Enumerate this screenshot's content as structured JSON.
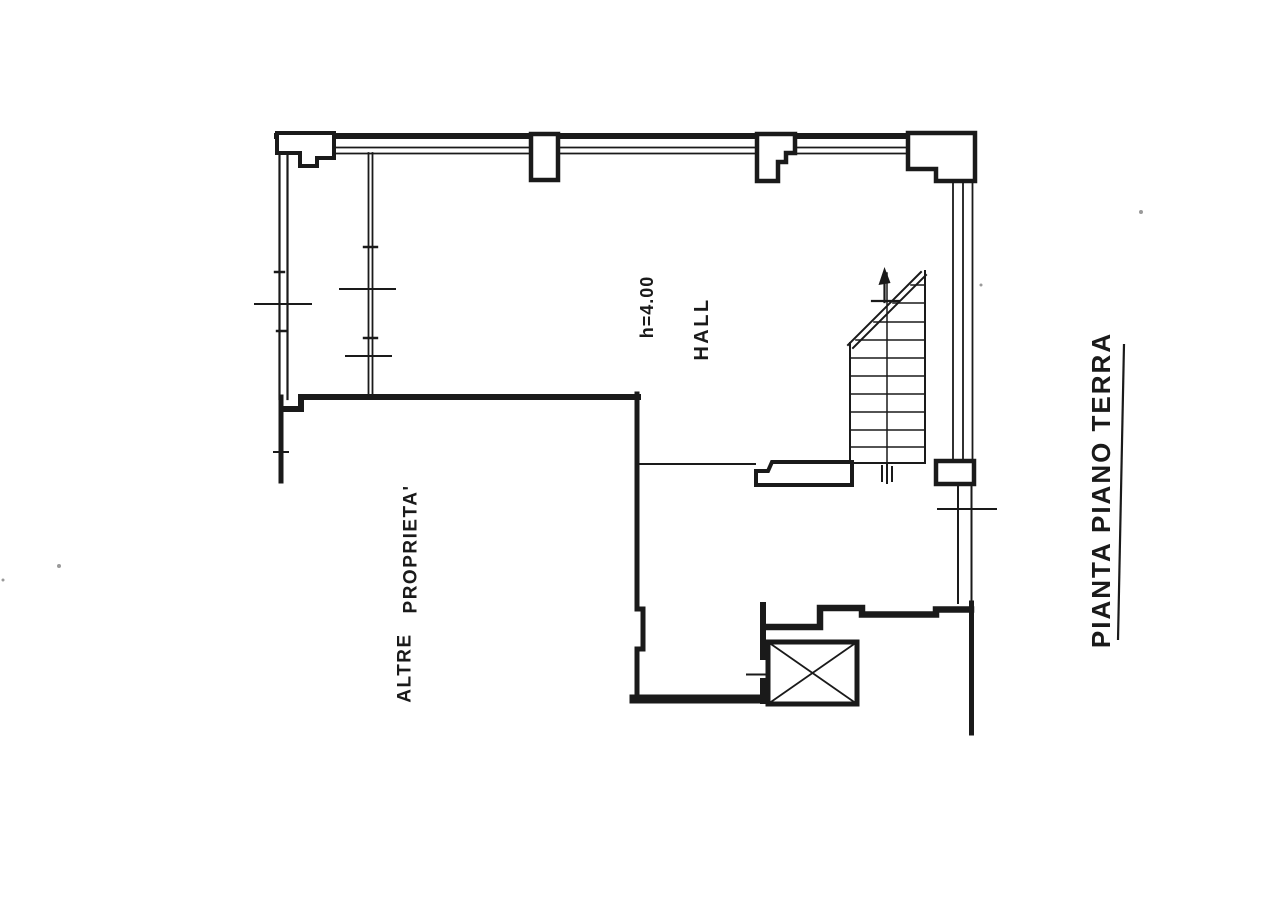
{
  "colors": {
    "background": "#ffffff",
    "ink": "#1a1a1a",
    "speck": "#9a9a9a"
  },
  "plan": {
    "title": "PIANTA PIANO TERRA",
    "room_labels": {
      "ceiling_height": "h=4.00",
      "hall": "HALL"
    },
    "annotations": {
      "other_property_word1": "ALTRE",
      "other_property_word2": "PROPRIETA'"
    },
    "symbols": [
      "staircase-plan-symbol",
      "elevator-x-symbol",
      "door-opening-tick",
      "wall-joint-ticks"
    ]
  }
}
